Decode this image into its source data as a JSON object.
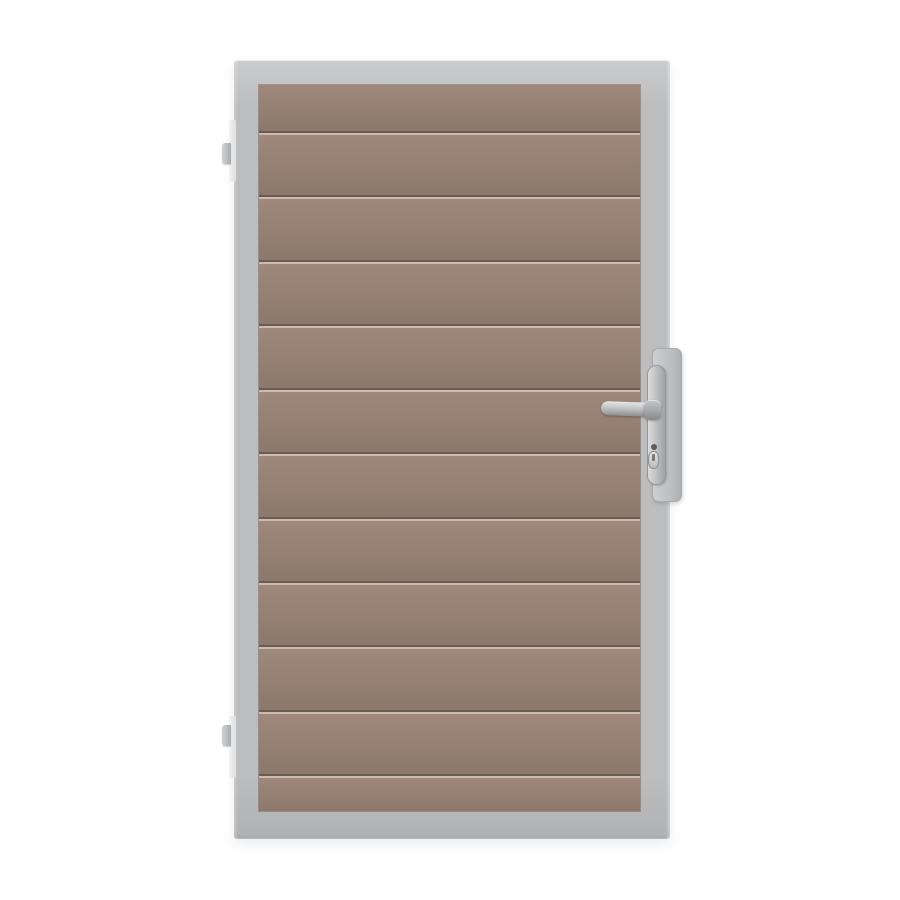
{
  "palette": {
    "bg": "#ffffff",
    "frame_light": "#cbccce",
    "frame_mid": "#bcbdbf",
    "frame_dark": "#b0b1b3",
    "slat_top": "#a0897b",
    "slat_bottom": "#8c786c",
    "groove_dark": "#6b5b53",
    "groove_light": "#cdbcae",
    "metal_light": "#e6e7e8",
    "metal_mid": "#bbbcbe",
    "metal_dark": "#8e8f91"
  },
  "gate": {
    "panel": {
      "slat_count": 12,
      "first_slat_height": 46,
      "last_slat_height": 37
    },
    "hinge_count": 2,
    "hardware": [
      "lever-handle",
      "escutcheon-plate",
      "lock-plate",
      "euro-cylinder-keyhole"
    ]
  }
}
